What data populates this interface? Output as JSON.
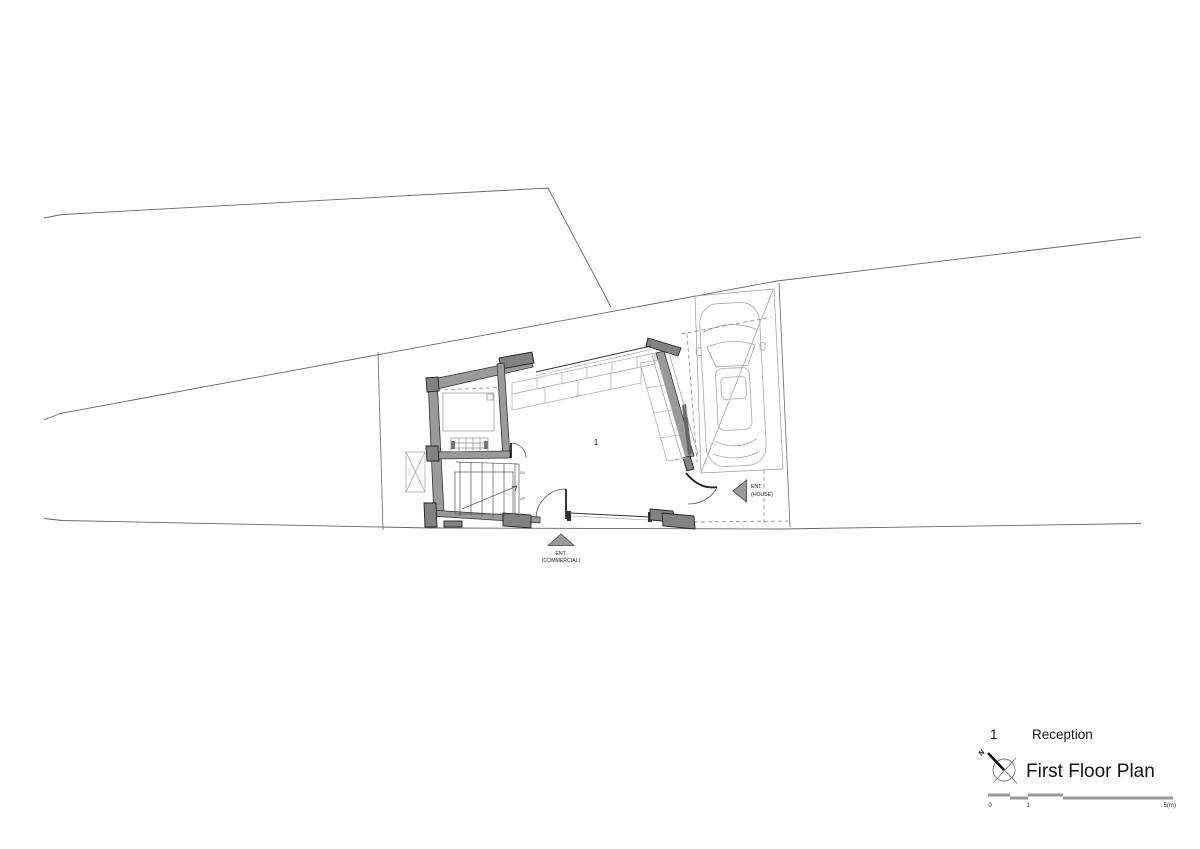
{
  "plan": {
    "room_number": "1",
    "entrance_commercial": {
      "line1": "ENT.",
      "line2": "(COMMERCIAL)"
    },
    "entrance_house": {
      "line1": "ENT.",
      "line2": "(HOUSE)"
    },
    "stair_label_top": "DN",
    "stair_label_bottom": "UP"
  },
  "legend": {
    "room_key": {
      "number": "1",
      "name": "Reception"
    },
    "title": "First Floor Plan",
    "north_label": "N",
    "scale": {
      "start": "0",
      "mid": "1",
      "end": "5(m)"
    }
  },
  "colors": {
    "wall_fill": "#9a9a9a",
    "pier_fill": "#828282",
    "line_dark": "#333333",
    "line_light": "#b3b3b3",
    "scale_bar": "#999999",
    "background": "#ffffff"
  }
}
